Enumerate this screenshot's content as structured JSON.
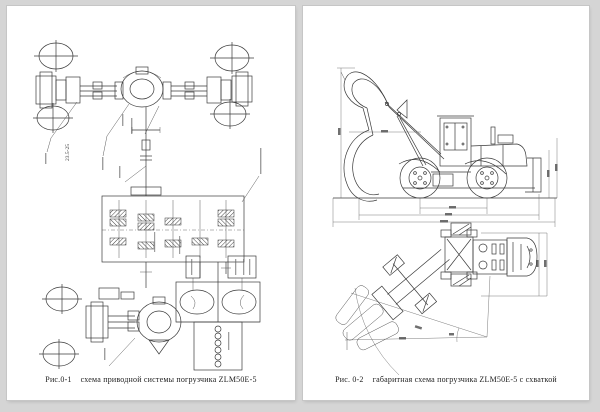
{
  "background_color": "#d5d5d5",
  "paper_color": "#ffffff",
  "ink_color": "#3a3a3a",
  "left_page": {
    "drawing": "drive-system-schematic",
    "tire_size_label": "23.5-25",
    "caption": {
      "figure": "Рис.0-1",
      "title": "схема приводной системы погрузчика ZLM50E-5"
    }
  },
  "right_page": {
    "drawing": "loader-dimensional-diagram",
    "caption": {
      "figure": "Рис. 0-2",
      "title": "габаритная схема погрузчика ZLM50E-5 с схваткой"
    }
  }
}
